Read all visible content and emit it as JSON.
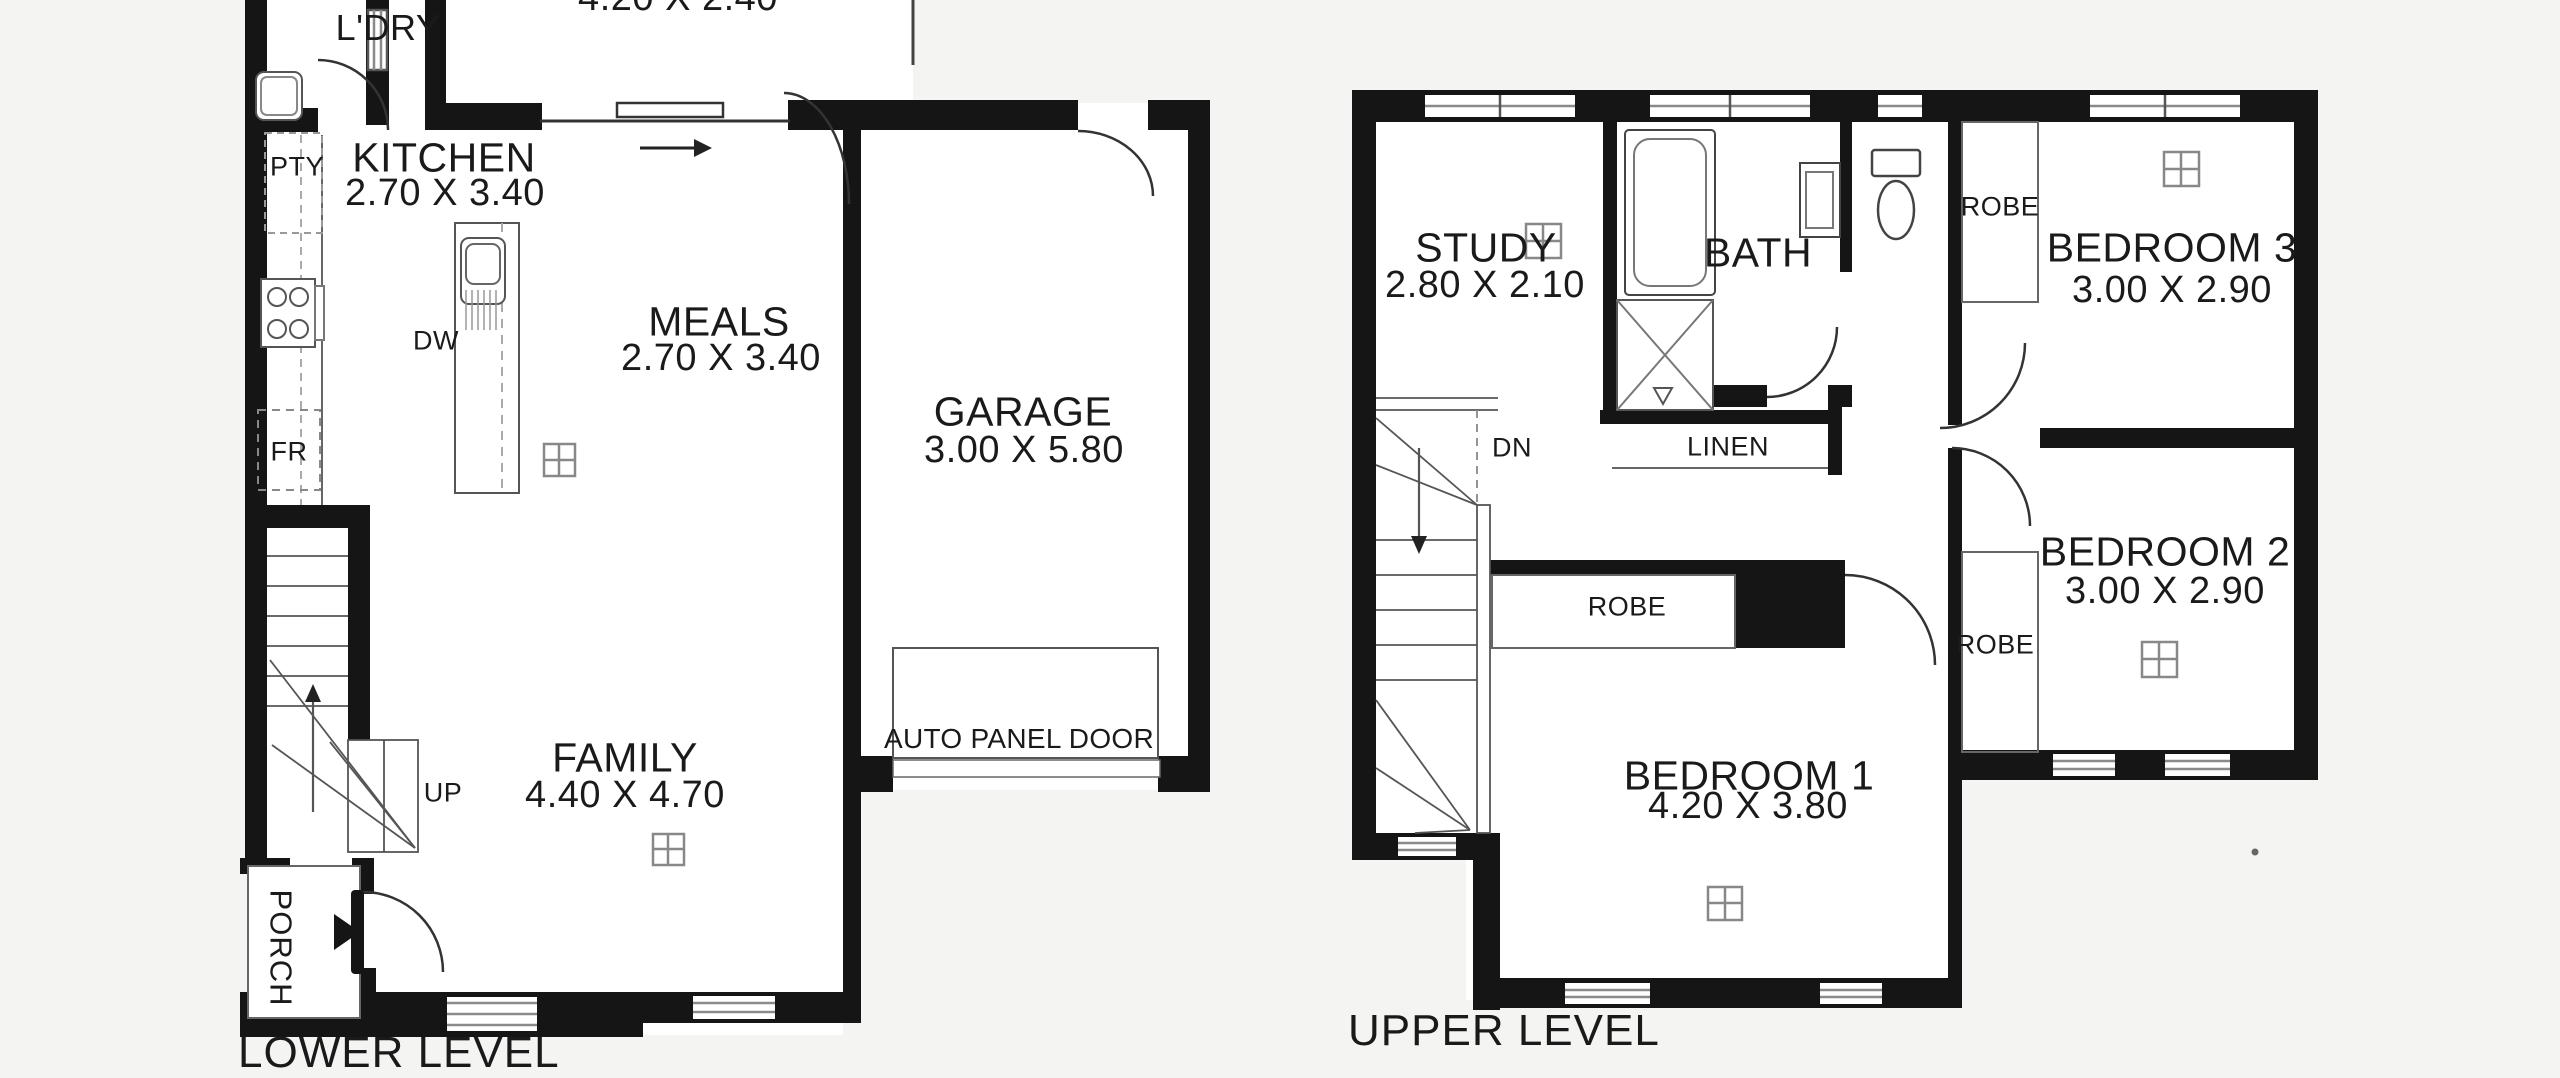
{
  "document": {
    "type": "real-estate floor plan, two levels",
    "background_color": "#f4f4f3",
    "wall_color": "#151515",
    "floor_color": "#ffffff",
    "line_gray": "#777777"
  },
  "lower_level": {
    "footer": "LOWER LEVEL",
    "rooms": {
      "top_room": {
        "dims": "4.20 X 2.40"
      },
      "laundry": {
        "name": "L'DRY"
      },
      "kitchen": {
        "name": "KITCHEN",
        "dims": "2.70 X 3.40"
      },
      "meals": {
        "name": "MEALS",
        "dims": "2.70 X 3.40"
      },
      "garage": {
        "name": "GARAGE",
        "dims": "3.00 X 5.80"
      },
      "family": {
        "name": "FAMILY",
        "dims": "4.40 X 4.70"
      },
      "porch": {
        "name": "PORCH"
      }
    },
    "labels": {
      "pantry": "PTY",
      "dishwasher": "DW",
      "fridge": "FR",
      "stairs_up": "UP",
      "garage_door": "AUTO PANEL DOOR"
    }
  },
  "upper_level": {
    "footer": "UPPER LEVEL",
    "rooms": {
      "study": {
        "name": "STUDY",
        "dims": "2.80 X 2.10"
      },
      "bath": {
        "name": "BATH"
      },
      "bedroom3": {
        "name": "BEDROOM 3",
        "dims": "3.00 X 2.90"
      },
      "bedroom2": {
        "name": "BEDROOM 2",
        "dims": "3.00 X 2.90"
      },
      "bedroom1": {
        "name": "BEDROOM 1",
        "dims": "4.20 X 3.80"
      }
    },
    "labels": {
      "stairs_down": "DN",
      "linen": "LINEN",
      "robe_bedroom3": "ROBE",
      "robe_bedroom2": "ROBE",
      "robe_bedroom1": "ROBE"
    }
  }
}
